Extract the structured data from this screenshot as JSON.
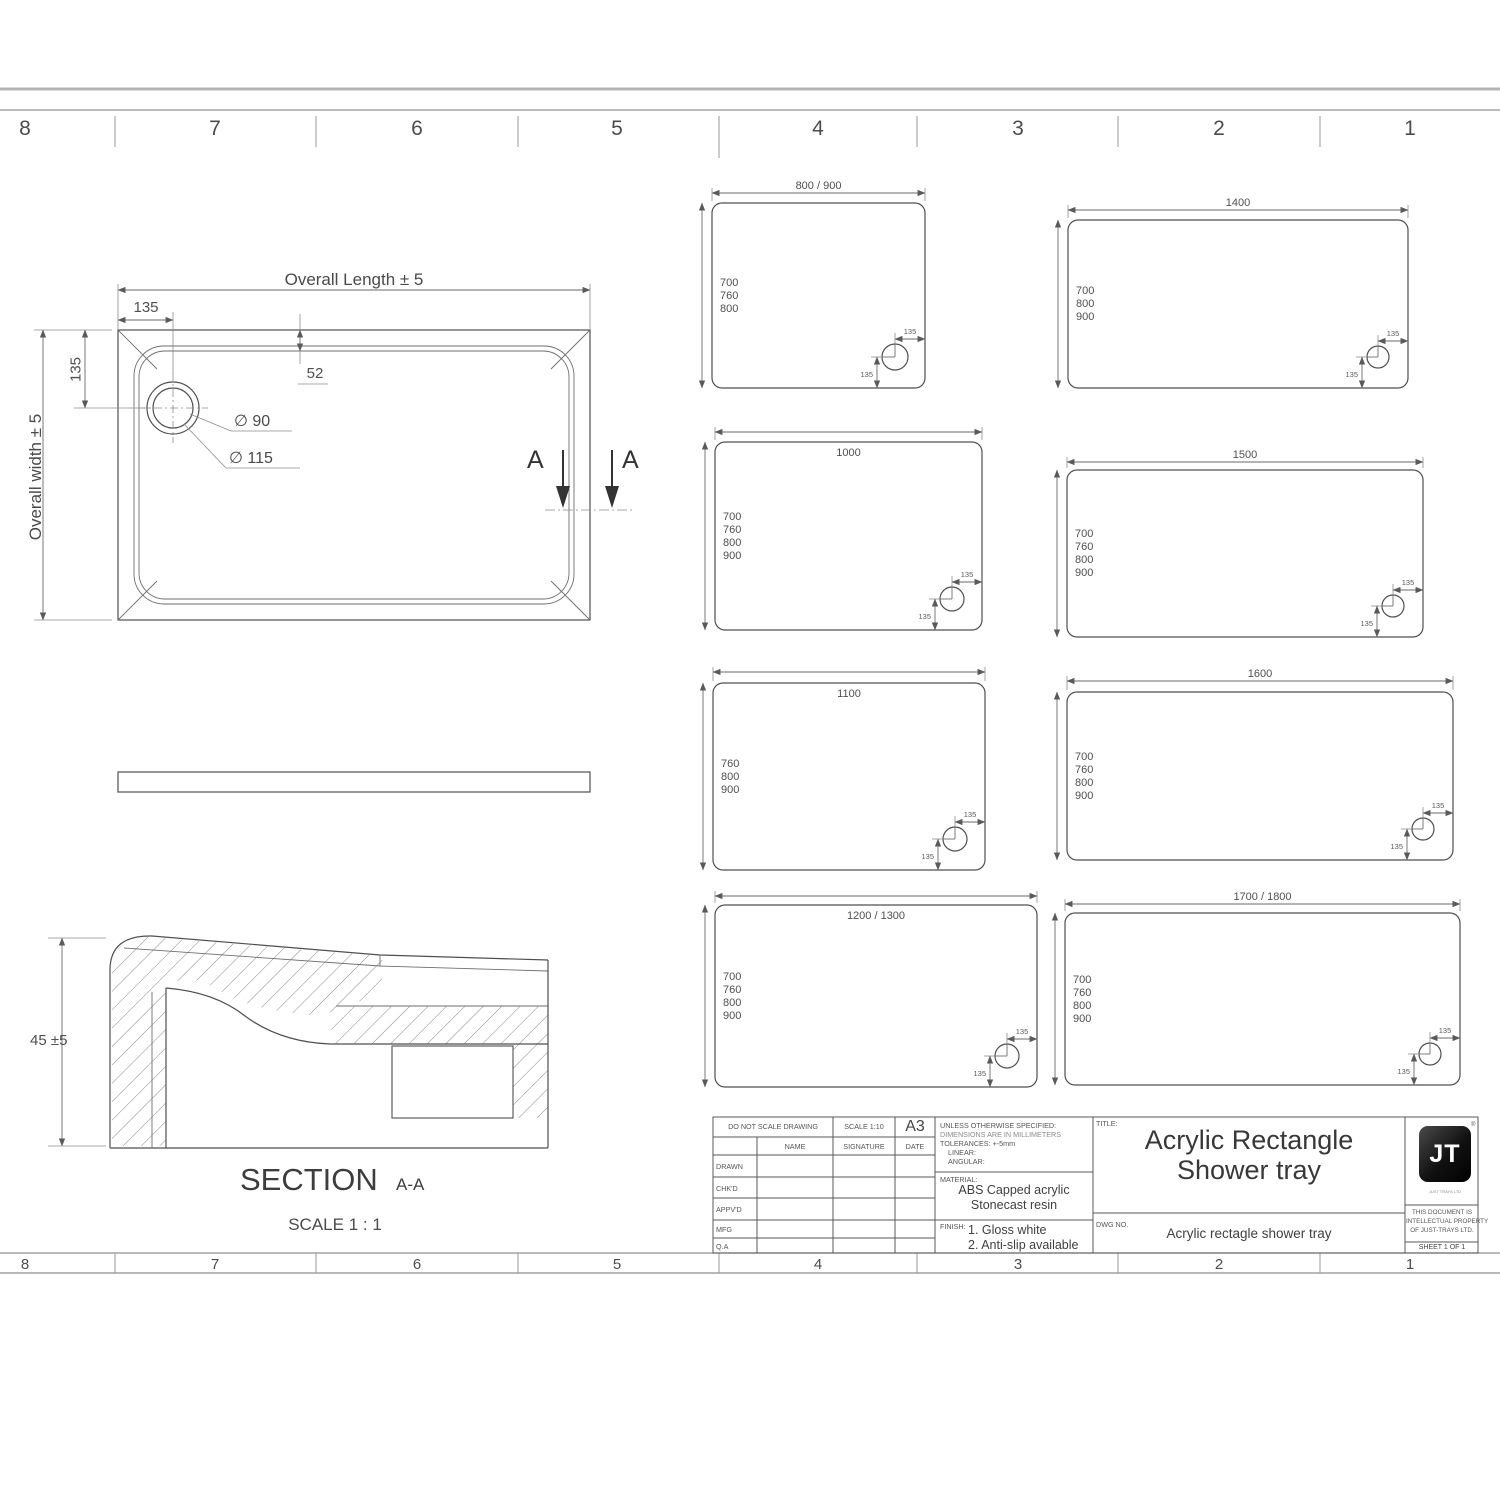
{
  "sheet": {
    "zone_numbers_top": [
      "8",
      "7",
      "6",
      "5",
      "4",
      "3",
      "2",
      "1"
    ],
    "zone_numbers_bottom": [
      "8",
      "7",
      "6",
      "5",
      "4",
      "3",
      "2",
      "1"
    ]
  },
  "plan_view": {
    "overall_length_label": "Overall Length ± 5",
    "overall_width_label": "Overall width ± 5",
    "dim_135_top": "135",
    "dim_135_left": "135",
    "dim_52": "52",
    "drain_diameter_inner": "∅ 90",
    "drain_diameter_outer": "∅ 115",
    "section_marker_left": "A",
    "section_marker_right": "A"
  },
  "side_view": {},
  "section_view": {
    "height_dim": "45 ±5",
    "title": "SECTION",
    "title_suffix": "A-A",
    "scale": "SCALE 1 : 1"
  },
  "size_variants": [
    {
      "length": "800 / 900",
      "widths": [
        "700",
        "760",
        "800"
      ],
      "drain_offset": "135"
    },
    {
      "length": "1400",
      "widths": [
        "700",
        "800",
        "900"
      ],
      "drain_offset": "135"
    },
    {
      "length": "1000",
      "widths": [
        "700",
        "760",
        "800",
        "900"
      ],
      "drain_offset": "135"
    },
    {
      "length": "1500",
      "widths": [
        "700",
        "760",
        "800",
        "900"
      ],
      "drain_offset": "135"
    },
    {
      "length": "1100",
      "widths": [
        "760",
        "800",
        "900"
      ],
      "drain_offset": "135"
    },
    {
      "length": "1600",
      "widths": [
        "700",
        "760",
        "800",
        "900"
      ],
      "drain_offset": "135"
    },
    {
      "length": "1200 / 1300",
      "widths": [
        "700",
        "760",
        "800",
        "900"
      ],
      "drain_offset": "135"
    },
    {
      "length": "1700 / 1800",
      "widths": [
        "700",
        "760",
        "800",
        "900"
      ],
      "drain_offset": "135"
    }
  ],
  "title_block": {
    "do_not_scale": "DO NOT SCALE DRAWING",
    "scale": "SCALE 1:10",
    "paper_size": "A3",
    "name_header": "NAME",
    "signature_header": "SIGNATURE",
    "date_header": "DATE",
    "rows": [
      "DRAWN",
      "CHK'D",
      "APPV'D",
      "MFG",
      "Q.A"
    ],
    "spec_line1": "UNLESS OTHERWISE SPECIFIED:",
    "spec_line2": "DIMENSIONS ARE IN MILLIMETERS",
    "spec_line3": "TOLERANCES: +-5mm",
    "spec_line4": "LINEAR:",
    "spec_line5": "ANGULAR:",
    "material_label": "MATERIAL:",
    "material_line1": "ABS Capped acrylic",
    "material_line2": "Stonecast resin",
    "finish_label": "FINISH:",
    "finish_line1": "1. Gloss white",
    "finish_line2": "2. Anti-slip available",
    "title_label": "TITLE:",
    "title_line1": "Acrylic Rectangle",
    "title_line2": "Shower tray",
    "dwg_no_label": "DWG NO.",
    "dwg_no": "Acrylic rectagle shower tray",
    "logo_text": "JT",
    "logo_reg_mark": "®",
    "logo_caption": "JUST TRAYS LTD",
    "property_line1": "THIS DOCUMENT IS",
    "property_line2": "INTELLECTUAL PROPERTY",
    "property_line3": "OF JUST-TRAYS LTD.",
    "sheet_no": "SHEET 1 OF 1"
  }
}
